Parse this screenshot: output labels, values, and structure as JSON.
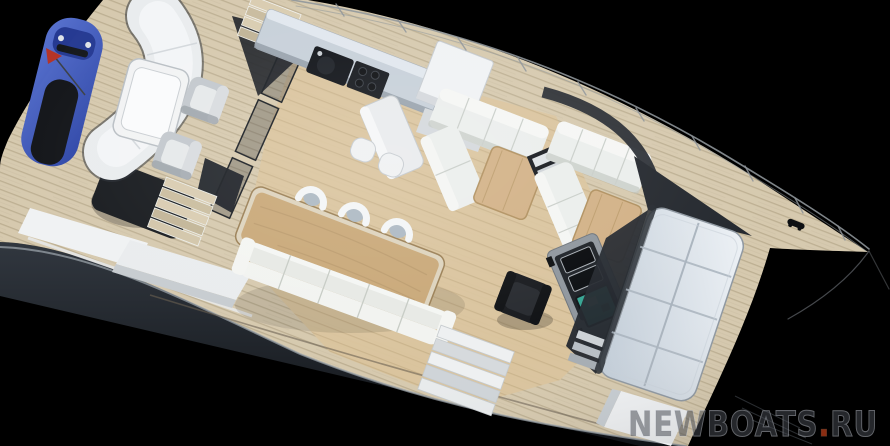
{
  "watermark": {
    "site": "NEWBOATS",
    "dot": ".",
    "domain": "RU"
  },
  "palette": {
    "background": "#000000",
    "hull": "#262b31",
    "teak": "#d6c9ae",
    "plank_line": "#b3a486",
    "interior_wood": "#dac49d",
    "interior_line": "#bfa87e",
    "sofa": "#ebeeec",
    "counter": "#c7d0d9",
    "appliance": "#101318",
    "wood_table": "#c9a878",
    "jetski": "#3a53b4",
    "black_seat": "#121418",
    "chart": "#36a593",
    "glazing": "#eef2f6",
    "frame_dark": "#24282e",
    "railing": "#8d9398",
    "watermark_dot": "#8a2d12"
  },
  "scene": {
    "subject": "Aerial 3D rendering of a motor yacht deck layout on a black background",
    "objects": [
      {
        "id": "jet-ski",
        "label": "blue personal watercraft stowed on aft deck"
      },
      {
        "id": "curved-sunpad",
        "label": "curved white aft lounge sofa"
      },
      {
        "id": "aft-coffee-table",
        "label": "white framed cocktail table"
      },
      {
        "id": "aft-armchairs",
        "label": "two grey cube armchairs"
      },
      {
        "id": "glass-partition",
        "label": "dark glass sliding partition and canopy"
      },
      {
        "id": "galley",
        "label": "galley counter with sink and cooktop"
      },
      {
        "id": "salon-sofas",
        "label": "two white L-shaped salon sofas with oak tables"
      },
      {
        "id": "companionway",
        "label": "stairs leading below deck"
      },
      {
        "id": "dining-set",
        "label": "long oak dining table, three shell chairs, bench sofa"
      },
      {
        "id": "helm",
        "label": "helm station with black seat and navigation screens"
      },
      {
        "id": "skylight",
        "label": "large glazed windshield / skylight panel"
      },
      {
        "id": "railings",
        "label": "wire deck railings converging at the bow"
      },
      {
        "id": "watermark",
        "label": "NEWBOATS.RU watermark"
      }
    ]
  }
}
